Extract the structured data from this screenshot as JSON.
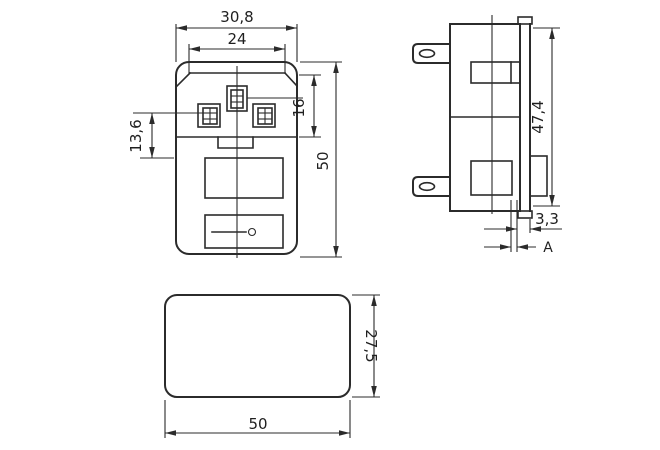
{
  "drawing": {
    "type": "technical-dimension-drawing",
    "subject": "fused IEC power inlet connector, three orthographic views",
    "colors": {
      "background": "#ffffff",
      "line": "#2b2b2b",
      "text": "#1f1f1f"
    },
    "front_view": {
      "dimensions": {
        "outer_width": "30,8",
        "recess_width": "24",
        "pin_depth": "16",
        "pin_offset": "13,6",
        "overall_height": "50"
      }
    },
    "side_view": {
      "dimensions": {
        "flange_height": "47,4",
        "flange_lip": "3,3",
        "panel_thickness": "A"
      }
    },
    "bottom_view": {
      "dimensions": {
        "depth": "27,5",
        "width": "50"
      }
    }
  }
}
